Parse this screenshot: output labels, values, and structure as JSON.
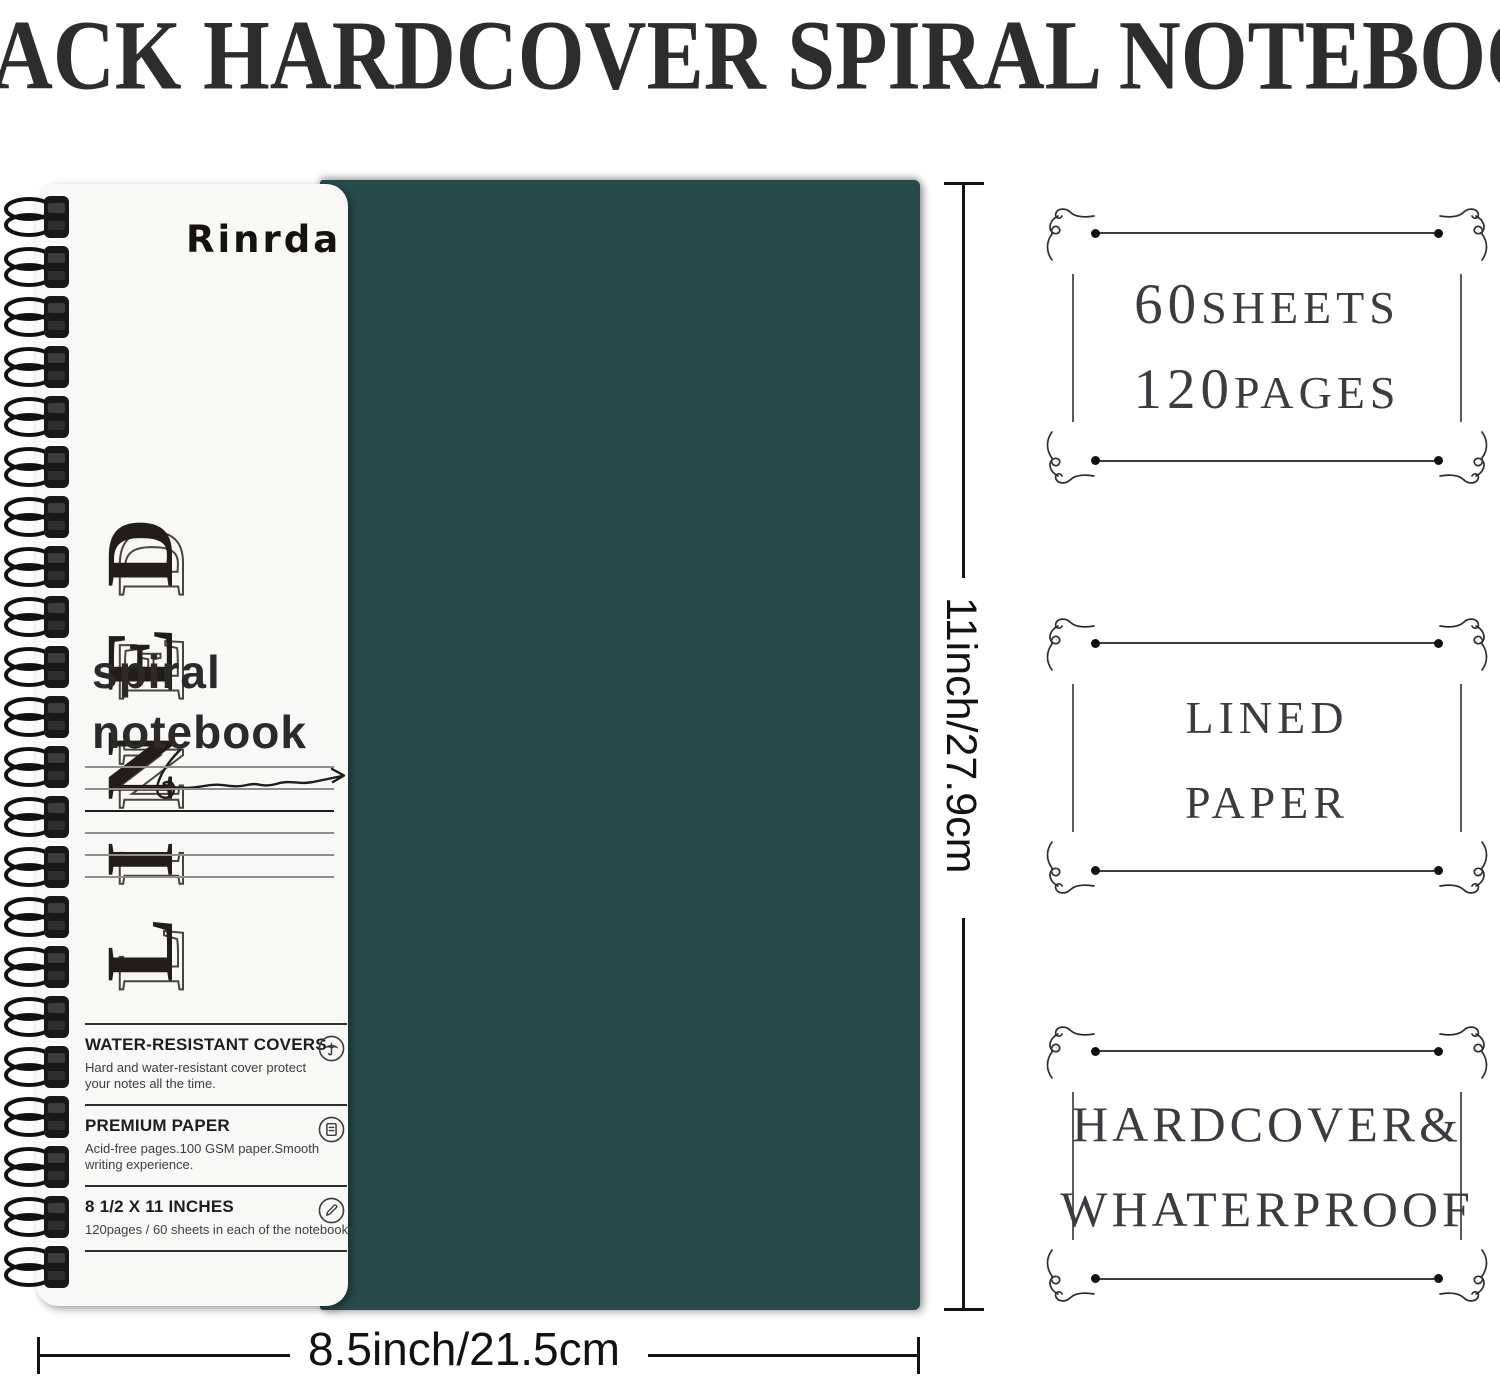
{
  "title": "8 PACK HARDCOVER SPIRAL NOTEBOOK",
  "notebook": {
    "brand": "Rinrda",
    "cover_word": "LINED",
    "cover_line1": "spiral",
    "cover_line2": "notebook",
    "cover_color": "#284a4b",
    "features": [
      {
        "title": "WATER-RESISTANT COVERS",
        "desc": "Hard and water-resistant cover protect your notes all the time.",
        "icon": "umbrella-icon"
      },
      {
        "title": "PREMIUM PAPER",
        "desc": "Acid-free pages.100 GSM paper.Smooth writing experience.",
        "icon": "paper-icon"
      },
      {
        "title": "8 1/2 X 11 INCHES",
        "desc": "120pages / 60 sheets in each of the notebooks.",
        "icon": "pencil-icon"
      }
    ]
  },
  "dimensions": {
    "height_label": "11inch/27.9cm",
    "width_label": "8.5inch/21.5cm"
  },
  "badges": [
    {
      "line1": {
        "num": "60",
        "word": "SHEETS"
      },
      "line2": {
        "num": "120",
        "word": "PAGES"
      }
    },
    {
      "line1": {
        "num": "",
        "word": "LINED"
      },
      "line2": {
        "num": "",
        "word": "PAPER"
      }
    },
    {
      "line1": {
        "num": "",
        "word": "HARDCOVER&"
      },
      "line2": {
        "num": "",
        "word": "WHATERPROOF"
      }
    }
  ]
}
